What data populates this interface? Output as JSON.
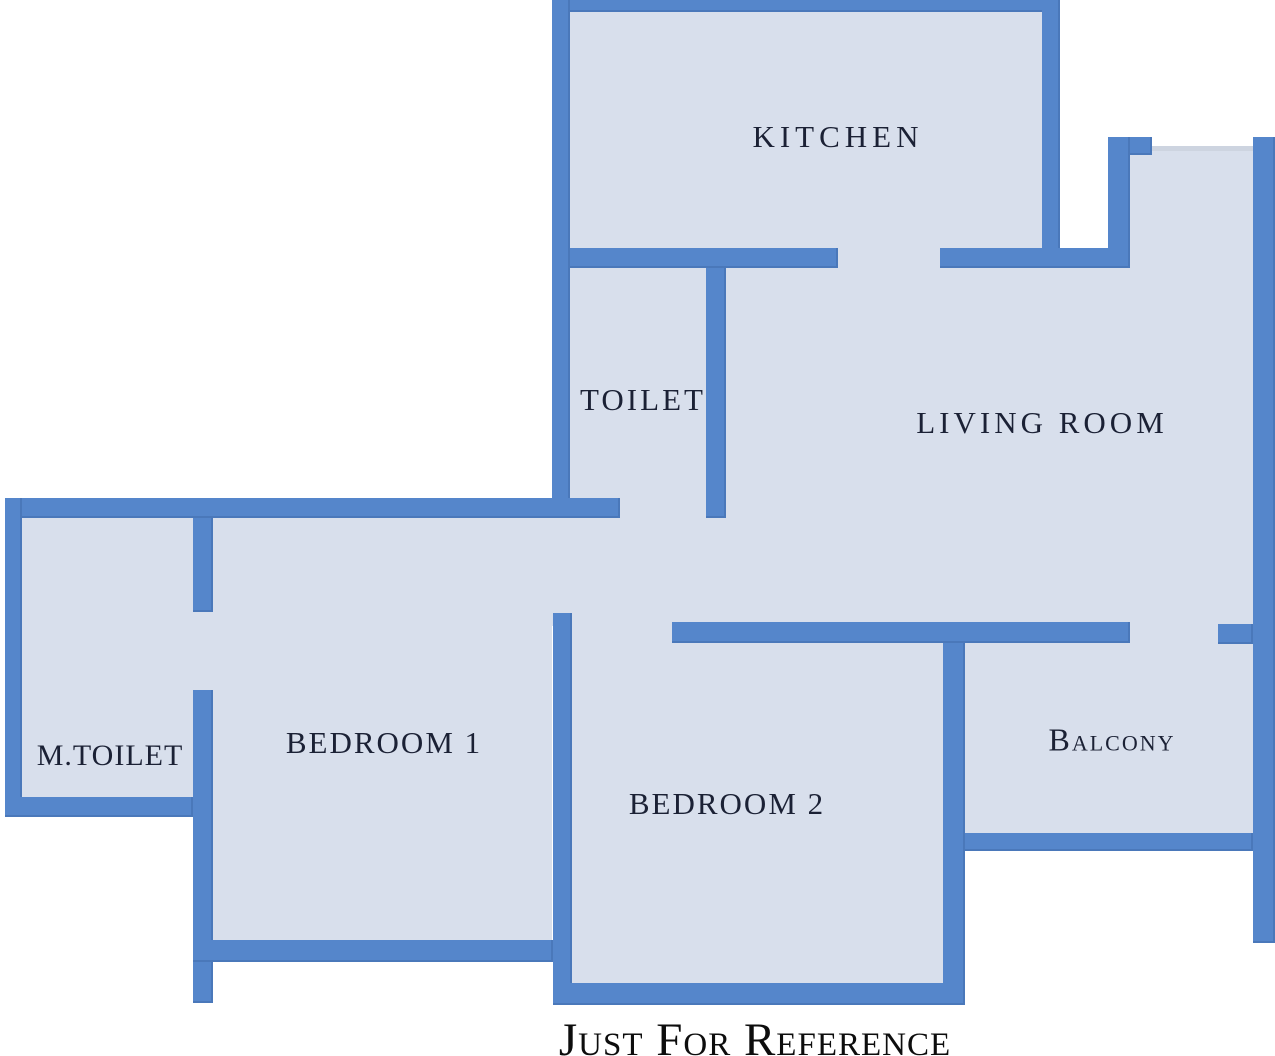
{
  "palette": {
    "wall_blue": "#5586cb",
    "room_fill": "#d8dfec",
    "label_color": "#1b2135",
    "window_line": "#cdd4e0",
    "footer_color": "#0d0d0d",
    "background": "#ffffff"
  },
  "rooms": [
    {
      "id": "kitchen",
      "label": "KITCHEN"
    },
    {
      "id": "toilet",
      "label": "TOILET"
    },
    {
      "id": "living-room",
      "label": "LIVING ROOM"
    },
    {
      "id": "m-toilet",
      "label": "M.TOILET"
    },
    {
      "id": "bedroom-1",
      "label": "BEDROOM 1"
    },
    {
      "id": "bedroom-2",
      "label": "BEDROOM 2"
    },
    {
      "id": "balcony",
      "label": "Balcony"
    }
  ],
  "footer": {
    "text": "Just For Reference"
  }
}
